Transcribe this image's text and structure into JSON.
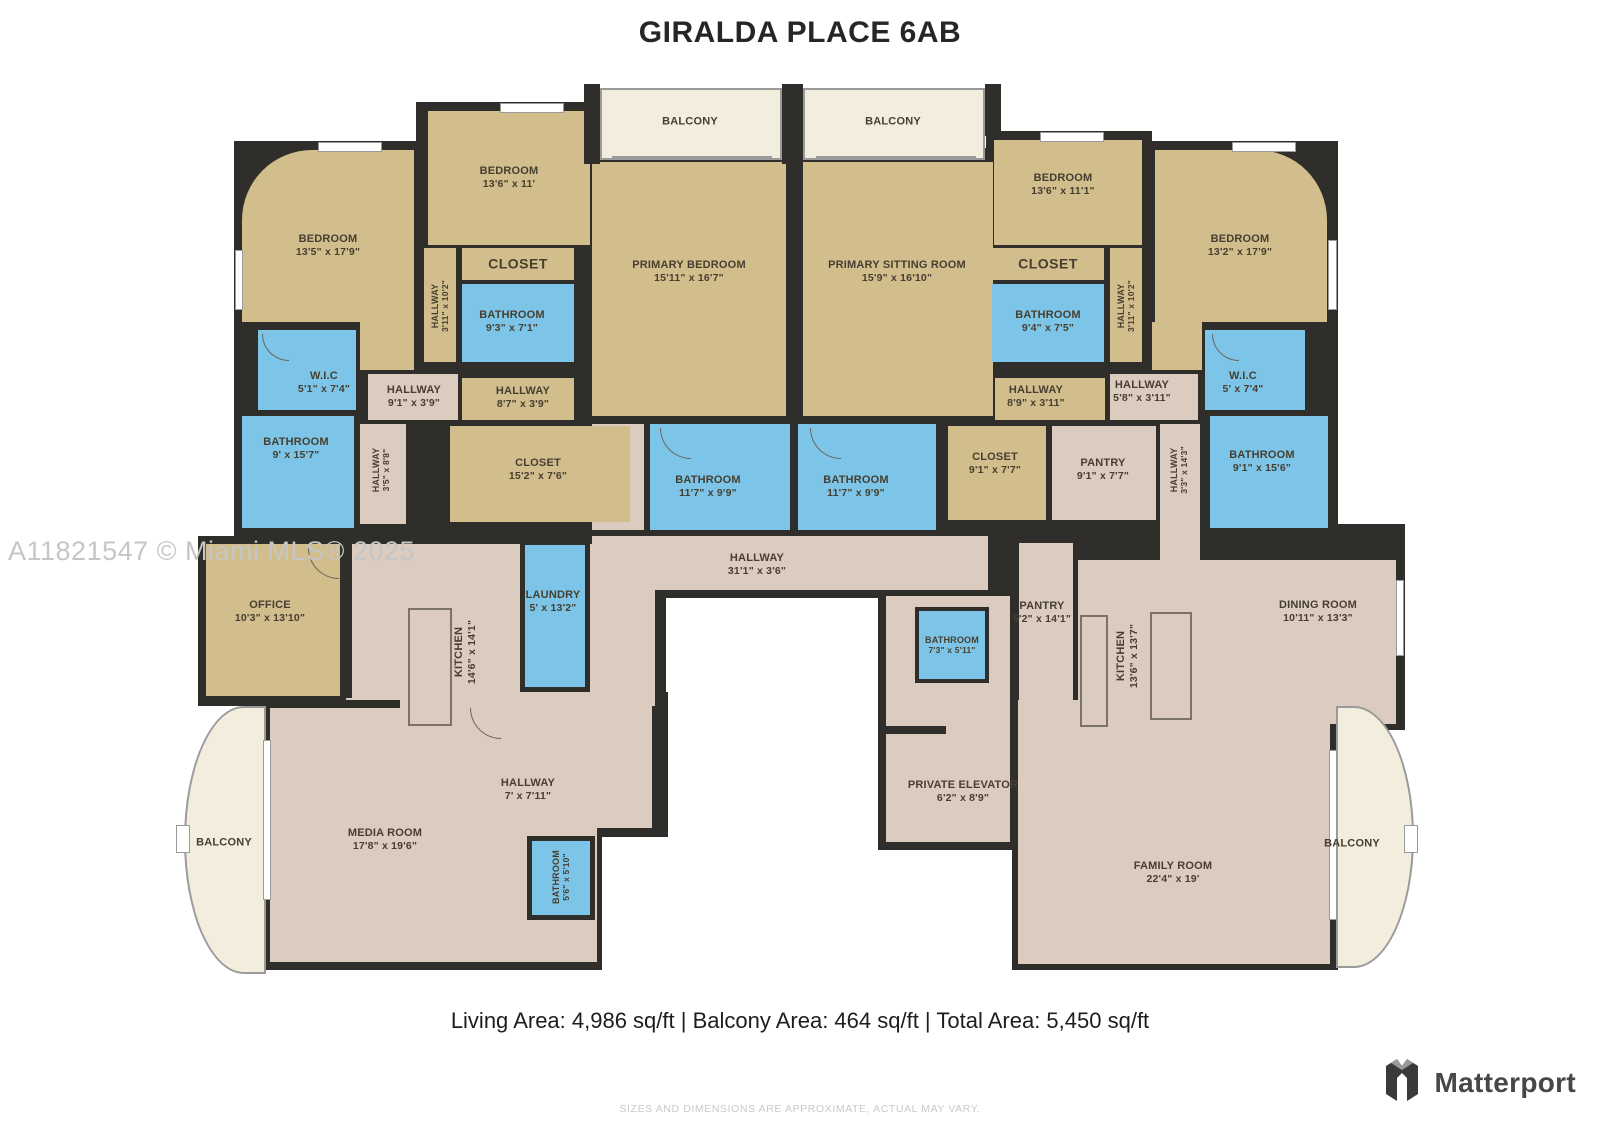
{
  "title": "GIRALDA PLACE 6AB",
  "watermark": "A11821547 © Miami MLS® 2025",
  "footer": {
    "area_summary": "Living Area: 4,986 sq/ft | Balcony Area: 464 sq/ft | Total Area: 5,450 sq/ft",
    "disclaimer": "SIZES AND DIMENSIONS ARE APPROXIMATE, ACTUAL MAY VARY.",
    "brand": "Matterport"
  },
  "palette": {
    "wall": "#2f2e2a",
    "bedroom_closet": "#d2bd8d",
    "bathroom_laundry": "#7cc5e8",
    "living_hallway": "#dccbbf",
    "balcony": "#f2eddc",
    "label_text": "#463f2f"
  },
  "rooms": [
    {
      "name": "BALCONY",
      "dims": ""
    },
    {
      "name": "BALCONY",
      "dims": ""
    },
    {
      "name": "BEDROOM",
      "dims": "13'6\" x 11'"
    },
    {
      "name": "BEDROOM",
      "dims": "13'5\" x 17'9\""
    },
    {
      "name": "PRIMARY BEDROOM",
      "dims": "15'11\" x 16'7\""
    },
    {
      "name": "PRIMARY SITTING ROOM",
      "dims": "15'9\" x 16'10\""
    },
    {
      "name": "BEDROOM",
      "dims": "13'6\" x 11'1\""
    },
    {
      "name": "BEDROOM",
      "dims": "13'2\" x 17'9\""
    },
    {
      "name": "CLOSET",
      "dims": ""
    },
    {
      "name": "BATHROOM",
      "dims": "9'3\" x 7'1\""
    },
    {
      "name": "CLOSET",
      "dims": ""
    },
    {
      "name": "BATHROOM",
      "dims": "9'4\" x 7'5\""
    },
    {
      "name": "HALLWAY",
      "dims": "3'11\" x 10'2\""
    },
    {
      "name": "HALLWAY",
      "dims": "3'11\" x 10'2\""
    },
    {
      "name": "W.I.C",
      "dims": "5'1\" x 7'4\""
    },
    {
      "name": "W.I.C",
      "dims": "5' x 7'4\""
    },
    {
      "name": "HALLWAY",
      "dims": "9'1\" x 3'9\""
    },
    {
      "name": "HALLWAY",
      "dims": "8'7\" x 3'9\""
    },
    {
      "name": "HALLWAY",
      "dims": "8'9\" x 3'11\""
    },
    {
      "name": "HALLWAY",
      "dims": "5'8\" x 3'11\""
    },
    {
      "name": "BATHROOM",
      "dims": "9' x 15'7\""
    },
    {
      "name": "BATHROOM",
      "dims": "9'1\" x 15'6\""
    },
    {
      "name": "HALLWAY",
      "dims": "3'5\" x 8'8\""
    },
    {
      "name": "HALLWAY",
      "dims": "3'3\" x 14'3\""
    },
    {
      "name": "CLOSET",
      "dims": "15'2\" x 7'6\""
    },
    {
      "name": "BATHROOM",
      "dims": "11'7\" x 9'9\""
    },
    {
      "name": "BATHROOM",
      "dims": "11'7\" x 9'9\""
    },
    {
      "name": "CLOSET",
      "dims": "9'1\" x 7'7\""
    },
    {
      "name": "PANTRY",
      "dims": "9'1\" x 7'7\""
    },
    {
      "name": "HALLWAY",
      "dims": "31'1\" x 3'6\""
    },
    {
      "name": "OFFICE",
      "dims": "10'3\" x 13'10\""
    },
    {
      "name": "KITCHEN",
      "dims": "14'6\" x 14'1\""
    },
    {
      "name": "LAUNDRY",
      "dims": "5' x 13'2\""
    },
    {
      "name": "MEDIA ROOM",
      "dims": "17'8\" x 19'6\""
    },
    {
      "name": "HALLWAY",
      "dims": "7' x 7'11\""
    },
    {
      "name": "BATHROOM",
      "dims": "5'6\" x 5'10\""
    },
    {
      "name": "BALCONY",
      "dims": ""
    },
    {
      "name": "PANTRY",
      "dims": "5'2\" x 14'1\""
    },
    {
      "name": "BATHROOM",
      "dims": "7'3\" x 5'11\""
    },
    {
      "name": "KITCHEN",
      "dims": "13'6\" x 13'7\""
    },
    {
      "name": "DINING ROOM",
      "dims": "10'11\" x 13'3\""
    },
    {
      "name": "PRIVATE ELEVATOR",
      "dims": "6'2\" x 8'9\""
    },
    {
      "name": "FAMILY ROOM",
      "dims": "22'4\" x 19'"
    },
    {
      "name": "BALCONY",
      "dims": ""
    }
  ]
}
